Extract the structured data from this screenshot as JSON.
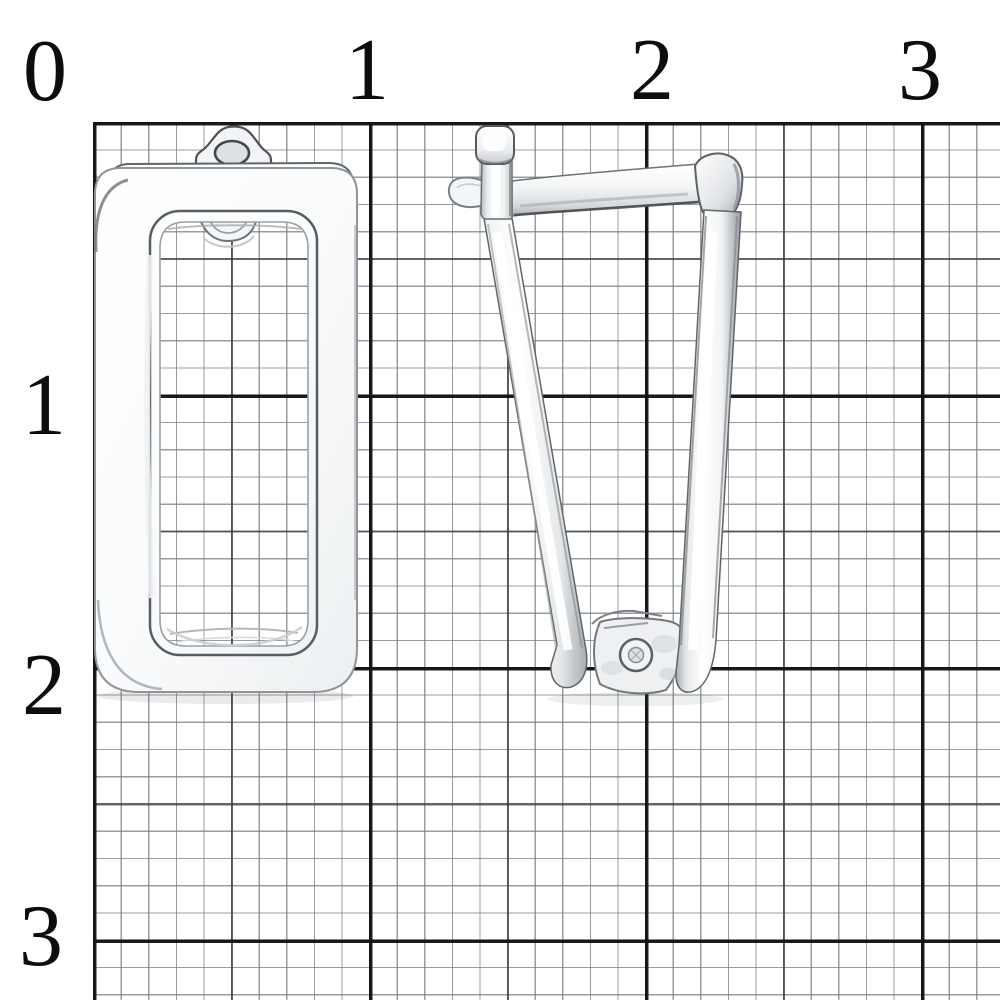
{
  "window": {
    "background_color": "#ffffff"
  },
  "ruler": {
    "top_labels": [
      {
        "text": "0"
      },
      {
        "text": "1"
      },
      {
        "text": "2"
      },
      {
        "text": "3"
      }
    ],
    "left_labels": [
      {
        "text": "1"
      },
      {
        "text": "2"
      },
      {
        "text": "3"
      }
    ],
    "font_color": "#0d0d0d"
  },
  "grid": {
    "fine_line_color": "#787c80",
    "medium_line_color": "#34373a",
    "major_line_color": "#121212",
    "mm_cell_px": 27.6,
    "cm_cell_px": 276
  },
  "photo": {
    "subject": "silver rectangular earrings on millimeter graph paper",
    "left_item": "earring-front-view",
    "right_item": "earring-side-view-open-clasp",
    "metal_highlight": "#ffffff",
    "metal_midtone": "#d9dcdf",
    "metal_shadow": "#8d9399",
    "edge_line": "#55595e"
  }
}
